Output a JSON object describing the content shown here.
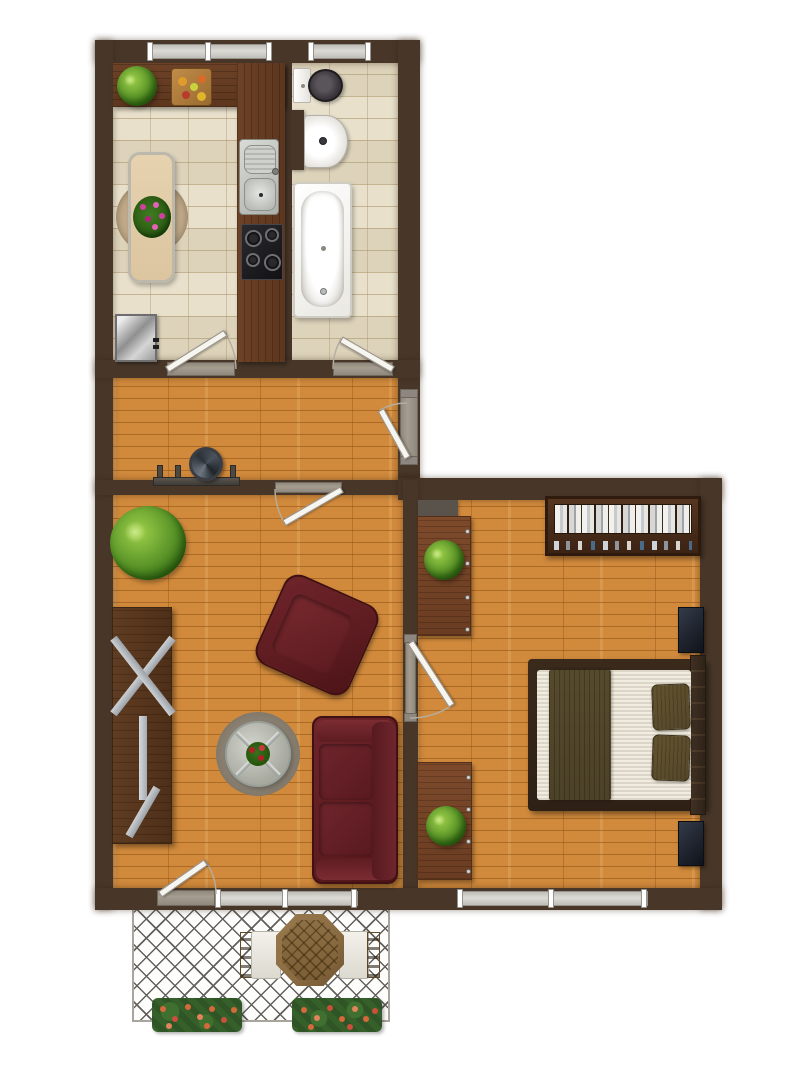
{
  "meta": {
    "type": "apartment-floor-plan",
    "description": "Top-down rendered floor plan of a one-bedroom apartment with kitchen, bathroom, hallway, living room, bedroom and balcony",
    "visible_text": []
  },
  "colors": {
    "background": "#ffffff",
    "wall": "#483729",
    "wood_base": "#d18a3c",
    "tile_floor": "#e8e0cb",
    "counter_wood": "#6d4227",
    "dresser_wood": "#7d4a2b",
    "desk_wood": "#5f3c22",
    "shelf_wood": "#563620",
    "sofa_red": "#5e1c21",
    "bed_frame": "#2f2015",
    "bed_blanket": "#4c4227",
    "bed_mattress": "#f1ece0",
    "pillow": "#55472a",
    "nightstand": "#1d222c",
    "rug_living": "#8b8274",
    "rug_kitchen": "#c2ac8c",
    "dining_table": "#dcc5a0",
    "balcony_wood": "#8a6b42",
    "plant_green": "#5a9428",
    "door_leaf": "#f7f5ef",
    "threshold": "#a59d90",
    "chimney": "#5a534b",
    "lattice_line": "#63605c",
    "flowerbox_green": "#2f5426",
    "flower_orange": "#d4693b",
    "flower_pink": "#d23f9e",
    "metal_gray": "#b9babc"
  },
  "rooms": {
    "kitchen": {
      "label": "kitchen",
      "fixtures": [
        "l-shaped-counter",
        "counter-plant",
        "cutting-board",
        "sink",
        "stove",
        "dining-table",
        "flower-centerpiece",
        "round-rug",
        "refrigerator"
      ]
    },
    "bathroom": {
      "label": "bathroom",
      "fixtures": [
        "toilet",
        "wash-basin",
        "partition-wall",
        "bathtub"
      ]
    },
    "hallway": {
      "label": "hallway",
      "fixtures": [
        "coat-rack",
        "round-mirror"
      ]
    },
    "living_room": {
      "label": "living room",
      "fixtures": [
        "floor-plant",
        "trestle-desk",
        "armchair",
        "sofa",
        "round-rug",
        "glass-coffee-table",
        "table-flowers"
      ]
    },
    "bedroom": {
      "label": "bedroom",
      "fixtures": [
        "bookshelf",
        "chimney-breast",
        "dresser-upper",
        "dresser-lower",
        "double-bed",
        "pillows",
        "nightstand-top",
        "nightstand-bottom",
        "dresser-plants"
      ]
    },
    "balcony": {
      "label": "balcony",
      "fixtures": [
        "bistro-table",
        "chair-left",
        "chair-right",
        "flower-box-left",
        "flower-box-right"
      ]
    }
  },
  "openings": {
    "doors": [
      "kitchen-door",
      "bathroom-door",
      "living-room-door",
      "bedroom-door",
      "entrance-door",
      "balcony-door"
    ],
    "windows": [
      "kitchen-window",
      "bathroom-window",
      "living-room-window",
      "bedroom-window"
    ]
  }
}
